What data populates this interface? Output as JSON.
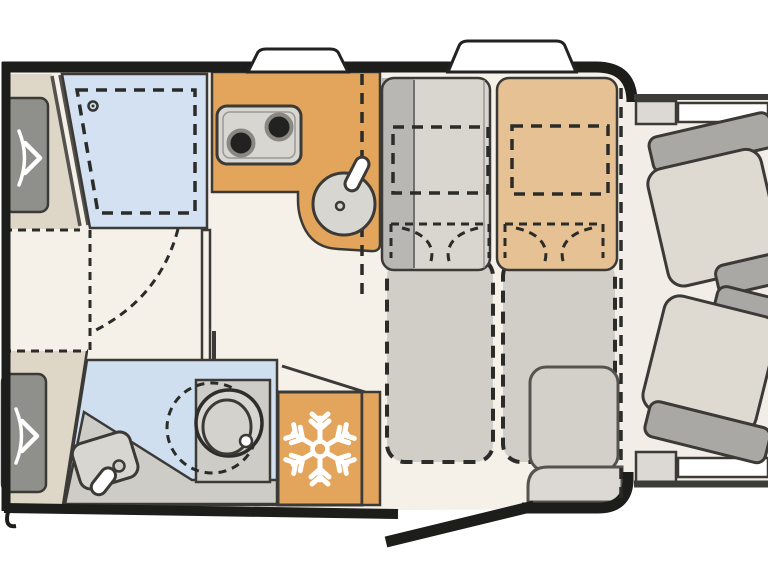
{
  "figure": {
    "type": "motorhome-floor-plan",
    "orientation": "cab-on-right-rear-on-left"
  },
  "palette": {
    "background": "#ffffff",
    "wall": "#1d1d1b",
    "floor": "#f5f1e8",
    "cab_floor": "#f2eee7",
    "kitchen_counter": "#e3a45b",
    "fridge": "#e3a45b",
    "bench_tan": "#e6c193",
    "bed_blue": "#d3e1f2",
    "bathroom_blue": "#cfdff0",
    "bench_gray": "#d9d5cf",
    "bench_strip": "#b9b7b4",
    "table_patch_gray": "#c9c6c1",
    "table_patch_tan": "#cec3b1",
    "bed_conversion": "#d1cec8",
    "bed_base": "#ded7c7",
    "pillow": "#8f8f8c",
    "fixture": "#d8d6d1",
    "fixture_inner": "#d4d2cd",
    "vanity": "#ceccc7",
    "burner": "#222221",
    "seat_cushion": "#ded9d1",
    "seat_frame": "#a9a8a5",
    "step": "#d3d0ca",
    "step_light": "#dcd9d4",
    "white": "#ffffff",
    "snowflake": "#ffffff",
    "door_line": "#54524e"
  },
  "items": [
    {
      "name": "rear-single-bed-top"
    },
    {
      "name": "rear-single-bed-bottom"
    },
    {
      "name": "drop-down-bed-blue"
    },
    {
      "name": "sliding-privacy-door"
    },
    {
      "name": "kitchen-counter-with-cooktop-and-sink"
    },
    {
      "name": "overhead-locker-dashline"
    },
    {
      "name": "fridge-with-snowflake-icon"
    },
    {
      "name": "bathroom-with-toilet-and-washbasin"
    },
    {
      "name": "lounge-bench-left"
    },
    {
      "name": "lounge-bench-right"
    },
    {
      "name": "bed-conversion-outlines"
    },
    {
      "name": "entry-door-open"
    },
    {
      "name": "entry-step"
    },
    {
      "name": "cab-swivel-seat-top"
    },
    {
      "name": "cab-swivel-seat-bottom"
    },
    {
      "name": "roof-vents"
    },
    {
      "name": "running-boards"
    }
  ]
}
